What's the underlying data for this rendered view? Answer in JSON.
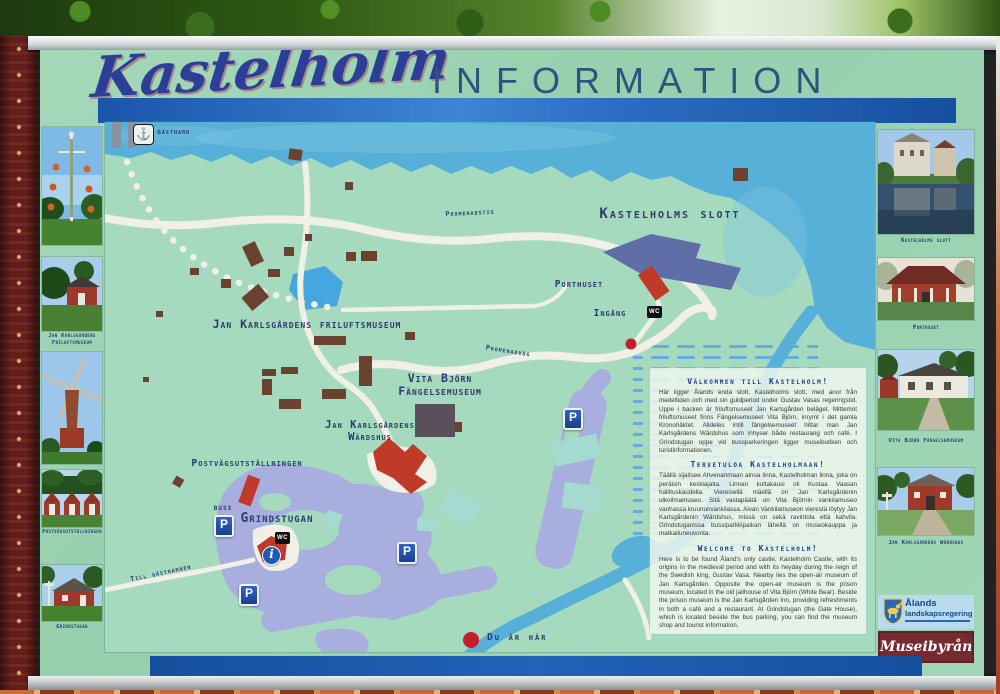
{
  "header": {
    "script_title": "Kastelholm",
    "info_title": "INFORMATION"
  },
  "map_labels": {
    "gasthamn": "Gästhamn",
    "promenadstig": "Promenadstig",
    "slott": "Kastelholms slott",
    "porthuset": "Porthuset",
    "ingang": "Ingång",
    "friluftsmuseum": "Jan Karlsgårdens friluftsmuseum",
    "promenadvag": "Promenadväg",
    "vita_bjorn_line1": "Vita Björn",
    "vita_bjorn_line2": "Fängelsemuseum",
    "wardshus_line1": "Jan Karlsgårdens",
    "wardshus_line2": "Wärdshus",
    "postvags": "Postvägsutställningen",
    "buss": "BUSS",
    "grindstugan": "Grindstugan",
    "till_gasthamnen": "Till gästhamnen",
    "du_ar_har": "Du är här",
    "parking_letter": "P",
    "info_letter": "i",
    "wc": "WC",
    "anchor_icon": "⚓"
  },
  "panel": {
    "sections": [
      {
        "heading": "Välkommen till Kastelholm!",
        "body": "Här ligger Ålands enda slott, Kastelholms slott, med anor från medeltiden och med sin guldperiod under Gustav Vasas regeringstid. Uppe i backen är friluftsmuseet Jan Karlsgården beläget. Mittemot friluftsmuseet finns Fängelsemuseet Vita Björn, inrymt i det gamla Kronohäktet. Alldeles intill fängelsemuseet hittar man Jan Karlsgårdens Wärdshus som inhyser både restaurang och café. I Grindstugan uppe vid bussparkeringen ligger museibutiken och turistinformationen."
      },
      {
        "heading": "Tervetuloa Kastelholmaan!",
        "body": "Täällä sijaitsee Ahvenanmaan ainoa linna, Kastelholman linna, joka on peräisin keskiajalta. Linnan kultakausi oli Kustaa Vaasan hallituskaudella. Viereisellä mäellä on Jan Karlsgårdenin ulkoilmamuseo. Sitä vastapäätä on Vita Björnin vankilamuseo vanhassa kruununvankilassa. Aivan Vankilamuseon vierestä löytyy Jan Karlsgårdenin Wärdshus, missä on sekä ravintola että kahvila. Grindstuganissa bussiparkkipaikan lähellä on museokauppa ja matkailuneuvonta."
      },
      {
        "heading": "Welcome to Kastelholm!",
        "body": "Here is to be found Åland's only castle, Kastelholm Castle, with its origins in the medieval period and with its heyday during the reign of the Swedish king, Gustav Vasa. Nearby lies the open-air museum of Jan Karlsgården. Opposite the open-air museum is the prison museum, located in the old jailhouse of Vita Björn (White Bear). Beside the prison museum is the Jan Karlsgården Inn, providing refreshments in both a café and a restaurant. At Grindstugan (the Gate House), which is located beside the bus parking, you can find the museum shop and tourist information."
      }
    ]
  },
  "left_column": {
    "captions": {
      "friluft": "Jan Karlsgårdens Friluftsmuseum",
      "postvags": "Postvägsutställningen",
      "grindstugan": "Grindstugan"
    }
  },
  "right_column": {
    "captions": {
      "slott": "Kastelholms slott",
      "porthuset": "Porthuset",
      "vita": "Vita Björn Fängelsemuseum",
      "wardshus": "Jan Karlsgårdens Wärdshus"
    }
  },
  "logos": {
    "government_line1": "Ålands",
    "government_line2": "landskapsregering",
    "bureau": "Museibyrån"
  },
  "colors": {
    "board_green": "#9bd3b3",
    "bar_blue": "#2163b8",
    "water_blue": "#57b0d8",
    "building_red": "#bf3a28",
    "building_brown": "#6b4130",
    "castle_slate": "#5f6ea6",
    "parking_lavender": "#a8aede",
    "label_navy": "#2d3a6e"
  }
}
